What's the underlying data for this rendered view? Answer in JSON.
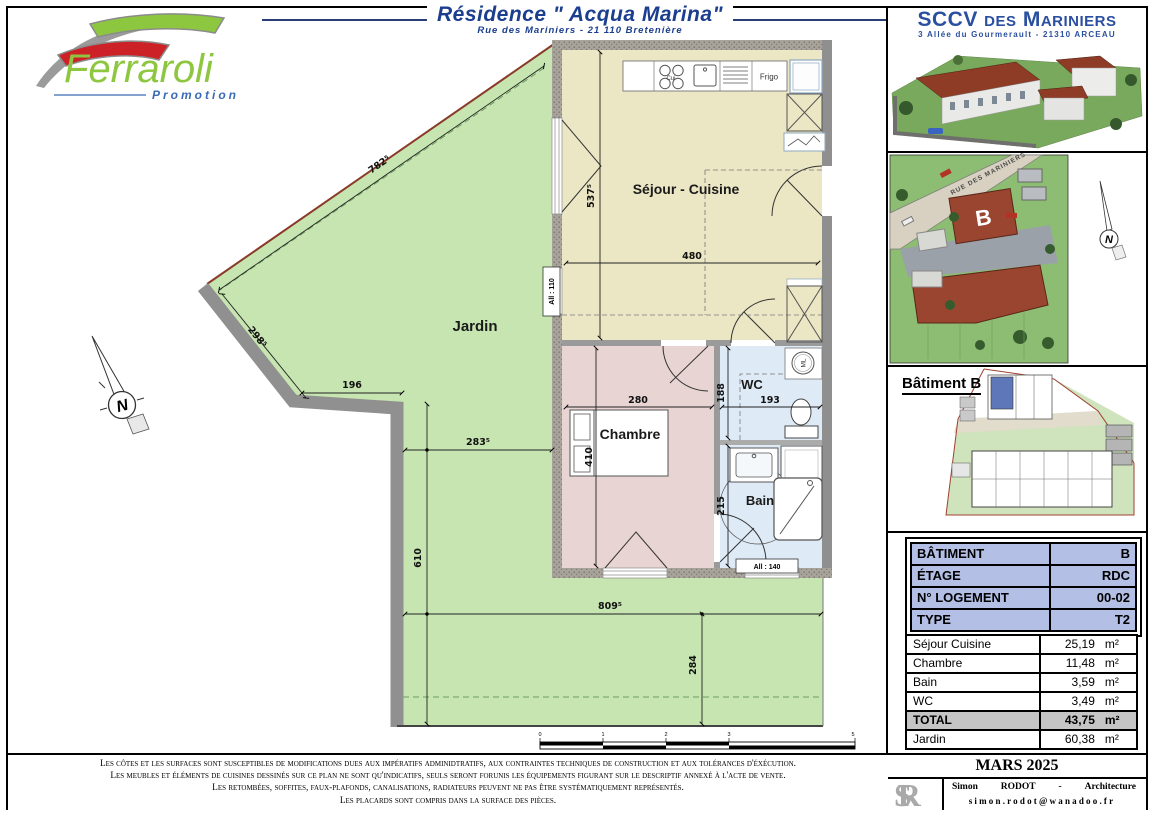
{
  "header": {
    "logo_name": "Ferraroli",
    "logo_tagline": "Promotion",
    "title": "Résidence \" Acqua Marina\"",
    "subtitle": "Rue des Mariniers - 21 110 Bretenière"
  },
  "sidebar": {
    "company_name": "SCCV des Mariniers",
    "company_address": "3 Allée du Gourmerault - 21310 ARCEAU",
    "street_label": "RUE DES MARINIERS",
    "building_marker": "B",
    "site_north": "N",
    "building_label": "Bâtiment B",
    "info_table": {
      "rows": [
        {
          "label": "BÂTIMENT",
          "value": "B"
        },
        {
          "label": "ÉTAGE",
          "value": "RDC"
        },
        {
          "label": "N° LOGEMENT",
          "value": "00-02"
        },
        {
          "label": "TYPE",
          "value": "T2"
        }
      ]
    },
    "surface_table": {
      "rows": [
        {
          "label": "Séjour Cuisine",
          "value": "25,19",
          "unit": "m²"
        },
        {
          "label": "Chambre",
          "value": "11,48",
          "unit": "m²"
        },
        {
          "label": "Bain",
          "value": "3,59",
          "unit": "m²"
        },
        {
          "label": "WC",
          "value": "3,49",
          "unit": "m²"
        },
        {
          "label": "TOTAL",
          "value": "43,75",
          "unit": "m²"
        },
        {
          "label": "Jardin",
          "value": "60,38",
          "unit": "m²"
        }
      ]
    },
    "footer": {
      "date": "MARS 2025",
      "sr": "SR",
      "architect_first": "Simon",
      "architect_last": "RODOT",
      "architect_sep": "-",
      "architect_title": "Architecture",
      "email": "simon.rodot@wanadoo.fr"
    }
  },
  "plan": {
    "rooms": {
      "jardin": "Jardin",
      "sejour": "Séjour - Cuisine",
      "chambre": "Chambre",
      "wc": "WC",
      "bain": "Bain"
    },
    "fixtures": {
      "frigo": "Frigo",
      "stove": "Cui",
      "washer": "ML"
    },
    "windows": {
      "left": "All : 110",
      "bottom": "All : 140"
    },
    "north_letter": "N",
    "dims": {
      "jardin_diag_top": "782⁵",
      "jardin_diag_left": "298⁵",
      "jardin_wall": "196",
      "jardin_width": "283⁵",
      "jardin_height": "610",
      "jardin_bottom": "809⁵",
      "jardin_bottom_height": "284",
      "sejour_h": "537⁵",
      "sejour_w": "480",
      "chambre_w": "280",
      "chambre_h": "410",
      "wc_h": "188",
      "wc_w": "193",
      "bain_h": "215"
    },
    "scale_ticks": [
      "0",
      "1",
      "2",
      "3",
      "5"
    ]
  },
  "disclaimer": {
    "lines": [
      "Les côtes et les surfaces sont susceptibles de modifications dues aux impératifs adminidtratifs, aux contraintes techniques de construction et aux tolérances d'éxécution.",
      "Les meubles et éléments de cuisines dessinés sur ce plan ne sont qu'indicatifs, seuls seront forunis les équipements figurant sur le descriptif annexé à l'acte de vente.",
      "Les retombées, soffites, faux-plafonds, canalisations, radiateurs peuvent ne pas être systématiquement représentés.",
      "Les placards sont compris dans la surface des pièces."
    ]
  }
}
